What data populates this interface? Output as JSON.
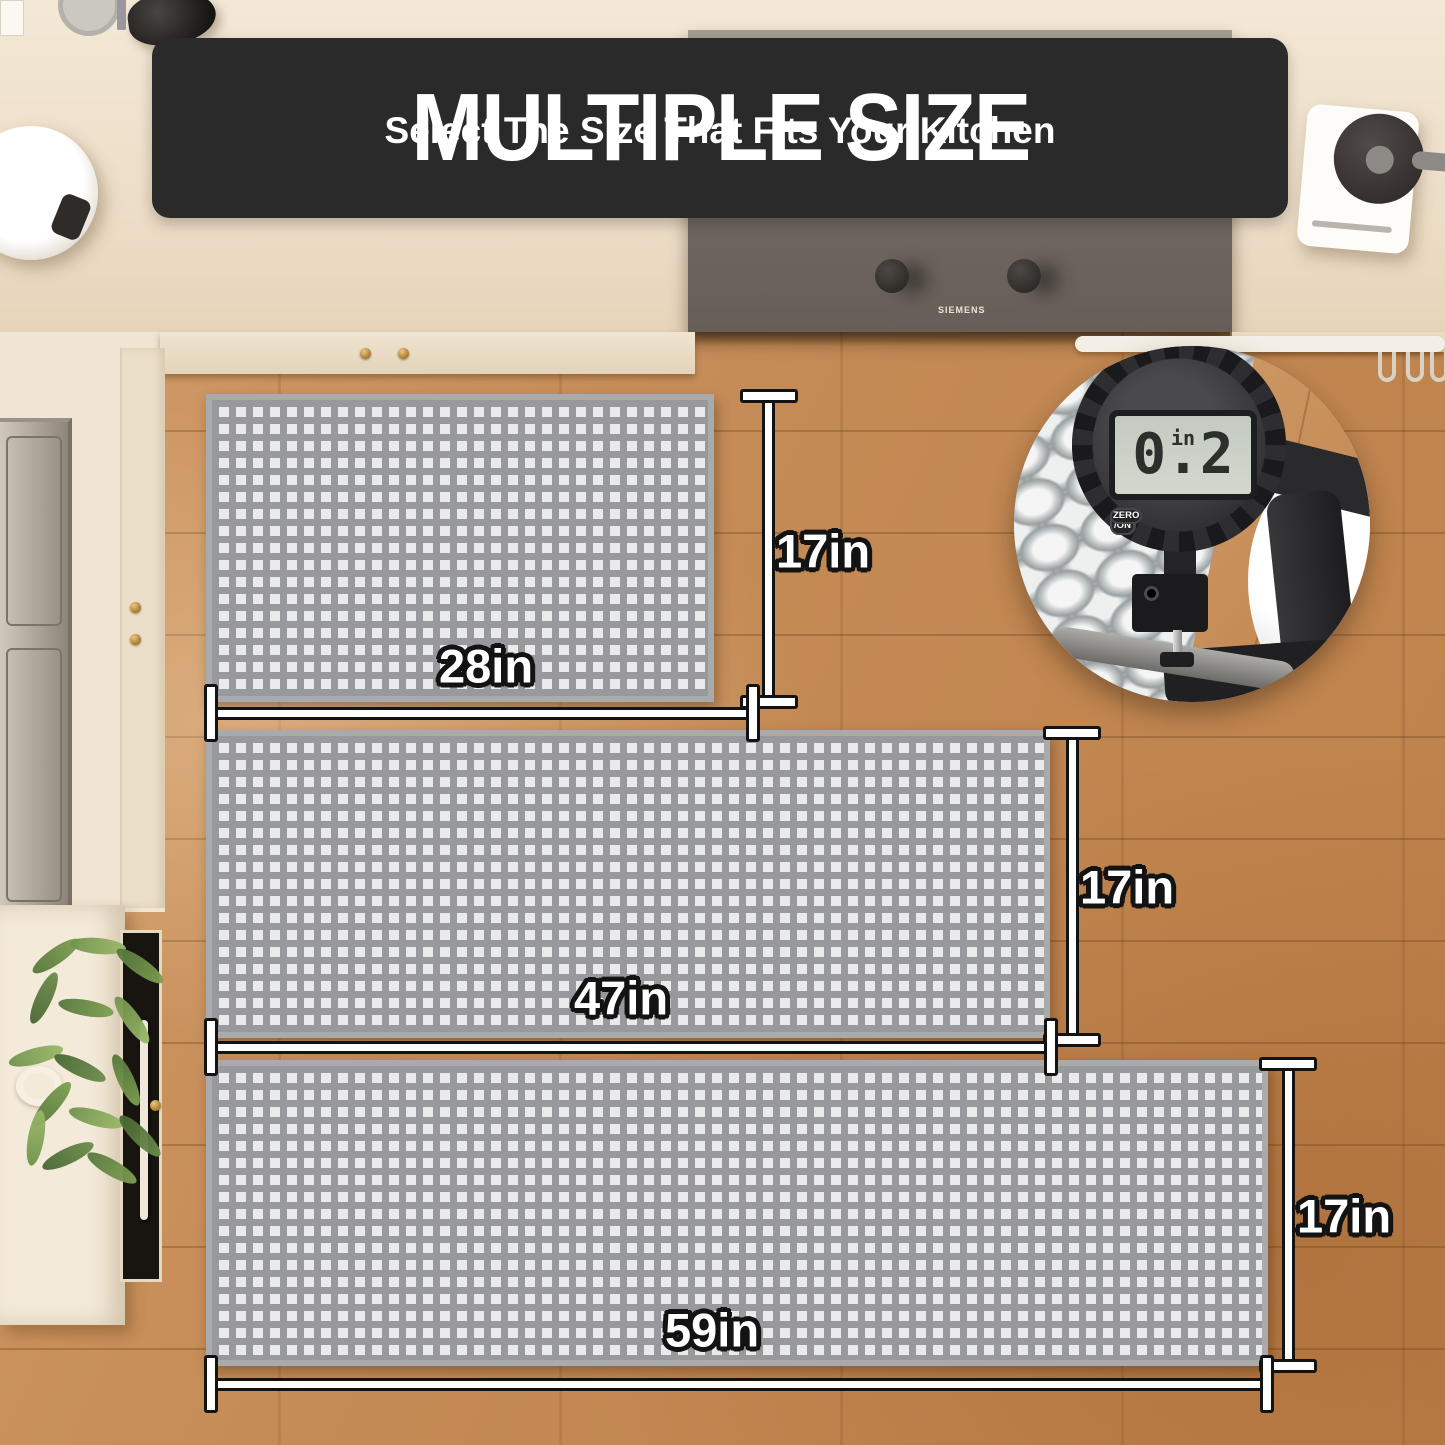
{
  "banner": {
    "title": "MULTIPLE SIZE",
    "subtitle": "Select The Size That Fits Your Kitchen",
    "bg_color": "#2b2a2a",
    "text_color": "#ffffff"
  },
  "cooktop": {
    "brand": "SIEMENS"
  },
  "thickness_gauge": {
    "display_value": "0.2",
    "display_unit": "in",
    "buttons": [
      {
        "label": "inch\n/mm"
      },
      {
        "label": "OFF\n/ON"
      },
      {
        "label": "ZERO"
      }
    ]
  },
  "mats": [
    {
      "width_label": "28in",
      "height_label": "17in"
    },
    {
      "width_label": "47in",
      "height_label": "17in"
    },
    {
      "width_label": "59in",
      "height_label": "17in"
    }
  ],
  "colors": {
    "mat_base": "#97999c",
    "mat_square": "#e9eae9",
    "mat_border": "#a9aaab",
    "label_fill": "#ffffff",
    "label_outline": "#131313",
    "lcd_bg": "#ccd2ce",
    "floor_wood": "#c48a55",
    "countertop": "#eee0cb"
  }
}
